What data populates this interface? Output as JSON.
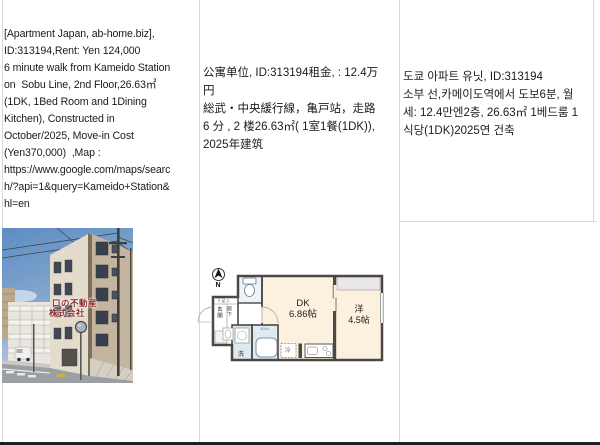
{
  "listing": {
    "english": "[Apartment Japan, ab-home.biz],\nID:313194,Rent: Yen 124,000\n6 minute walk from Kameido Station\non  Sobu Line, 2nd Floor,26.63㎡\n(1DK, 1Bed Room and 1Dining\nKitchen), Constructed in\nOctober/2025, Move-in Cost\n(Yen370,000)  ,Map :\nhttps://www.google.com/maps/searc\nh/?api=1&query=Kameido+Station&\nhl=en",
    "chinese": "公寓单位, ID:313194租金, : 12.4万\n円\n総武・中央緩行線，亀戸站，走路\n6 分 , 2 楼26.63㎡( 1室1餐(1DK)),\n2025年建筑",
    "korean": "도쿄 아파트 유닛, ID:313194\n소부 선,카메이도역에서 도보6분, 월\n세: 12.4만엔2층, 26.63㎡ 1베드룸 1\n식당(1DK)2025연 건축"
  },
  "photo": {
    "watermark_line1": "口の不動産",
    "watermark_line2": "株式会社"
  },
  "floorplan": {
    "north_label": "N",
    "dk_label": "DK",
    "dk_size": "6.86帖",
    "western_label": "洋",
    "western_size": "4.5帖",
    "entrance_label": "玄関",
    "hallway_label": "廊下",
    "wash_label": "洗",
    "fridge_label": "冷",
    "shoe_label": "下足入",
    "bath_size_label": "1014"
  },
  "colors": {
    "grid_border": "#d9d9d9",
    "bottom_bar": "#1f1f1f",
    "room_cream": "#fcf0df",
    "wet_area_blue": "#dfe9f1",
    "closet_gray": "#e9e7eb",
    "wall_dark": "#4b4744",
    "watermark_red": "#8b2d26",
    "sky_blue": "#6e9aca"
  }
}
